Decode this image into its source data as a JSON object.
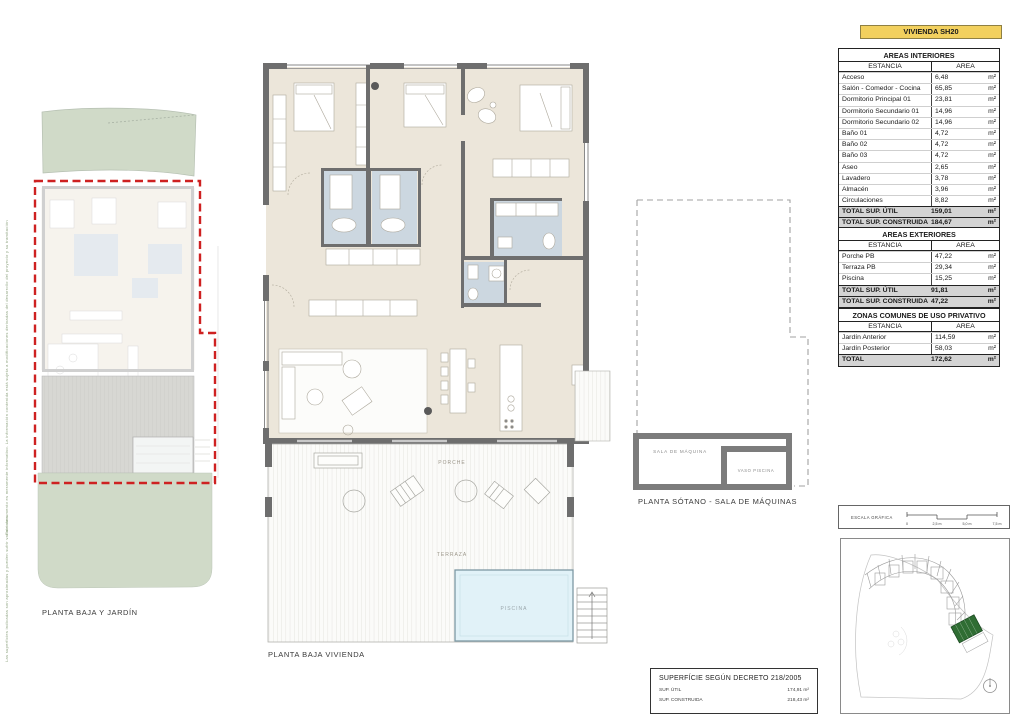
{
  "header": {
    "title": "VIVIENDA SH20",
    "banner_color": "#f2d05e"
  },
  "tables": {
    "col_estancia": "ESTANCIA",
    "col_area": "AREA",
    "unit": "m²",
    "interiores": {
      "title": "AREAS INTERIORES",
      "rows": [
        {
          "estancia": "Acceso",
          "area": "6,48"
        },
        {
          "estancia": "Salón - Comedor - Cocina",
          "area": "65,85"
        },
        {
          "estancia": "Dormitorio Principal 01",
          "area": "23,81"
        },
        {
          "estancia": "Dormitorio Secundario 01",
          "area": "14,96"
        },
        {
          "estancia": "Dormitorio Secundario 02",
          "area": "14,96"
        },
        {
          "estancia": "Baño 01",
          "area": "4,72"
        },
        {
          "estancia": "Baño 02",
          "area": "4,72"
        },
        {
          "estancia": "Baño 03",
          "area": "4,72"
        },
        {
          "estancia": "Aseo",
          "area": "2,65"
        },
        {
          "estancia": "Lavadero",
          "area": "3,78"
        },
        {
          "estancia": "Almacén",
          "area": "3,96"
        },
        {
          "estancia": "Circulaciones",
          "area": "8,82"
        }
      ],
      "totals": [
        {
          "estancia": "TOTAL SUP. ÚTIL",
          "area": "159,01"
        },
        {
          "estancia": "TOTAL SUP. CONSTRUIDA",
          "area": "184,67"
        }
      ]
    },
    "exteriores": {
      "title": "AREAS EXTERIORES",
      "rows": [
        {
          "estancia": "Porche PB",
          "area": "47,22"
        },
        {
          "estancia": "Terraza PB",
          "area": "29,34"
        },
        {
          "estancia": "Piscina",
          "area": "15,25"
        }
      ],
      "totals": [
        {
          "estancia": "TOTAL SUP. ÚTIL",
          "area": "91,81"
        },
        {
          "estancia": "TOTAL SUP. CONSTRUIDA",
          "area": "47,22"
        }
      ]
    },
    "zonas": {
      "title": "ZONAS COMUNES DE USO PRIVATIVO",
      "rows": [
        {
          "estancia": "Jardín Anterior",
          "area": "114,59"
        },
        {
          "estancia": "Jardín Posterior",
          "area": "58,03"
        }
      ],
      "totals": [
        {
          "estancia": "TOTAL",
          "area": "172,62"
        }
      ]
    }
  },
  "plans": {
    "left": {
      "caption": "PLANTA BAJA Y JARDÍN"
    },
    "center": {
      "caption": "PLANTA BAJA VIVIENDA",
      "labels": {
        "porche": "PORCHE",
        "terraza": "TERRAZA",
        "piscina": "PISCINA"
      }
    },
    "sotano": {
      "caption": "PLANTA SÓTANO - SALA DE MÁQUINAS",
      "labels": {
        "sala": "SALA DE MÁQUINA",
        "vaso": "VASO PISCINA"
      }
    }
  },
  "scalebar": {
    "label": "ESCALA GRÁFICA",
    "ticks": [
      "0",
      "2,5 m",
      "5,0 m",
      "7,5 m"
    ]
  },
  "decreto": {
    "title": "SUPERFÍCIE SEGÚN DECRETO 218/2005",
    "rows": [
      {
        "label": "SUP. ÚTIL",
        "value": "174,91 m²"
      },
      {
        "label": "SUP. CONSTRUIDA",
        "value": "218,43 m²"
      }
    ]
  },
  "disclaimer": {
    "line1": "Este documento es meramente informativo. La información contenida está sujeta a modificaciones derivadas del desarrollo del proyecto y su tramitación",
    "line2": "Las superficies indicadas son aproximadas y pueden sufrir variaciones"
  },
  "colors": {
    "floor_beige": "#ece6da",
    "bath_blue": "#ccd7e0",
    "wall_gray": "#6e6e6e",
    "pool_blue": "#e1f2f8",
    "garden_green": "#d0dac8",
    "red_outline": "#ce2121",
    "highlight_green": "#2f6d33",
    "total_row_gray": "#d4d4d4"
  }
}
